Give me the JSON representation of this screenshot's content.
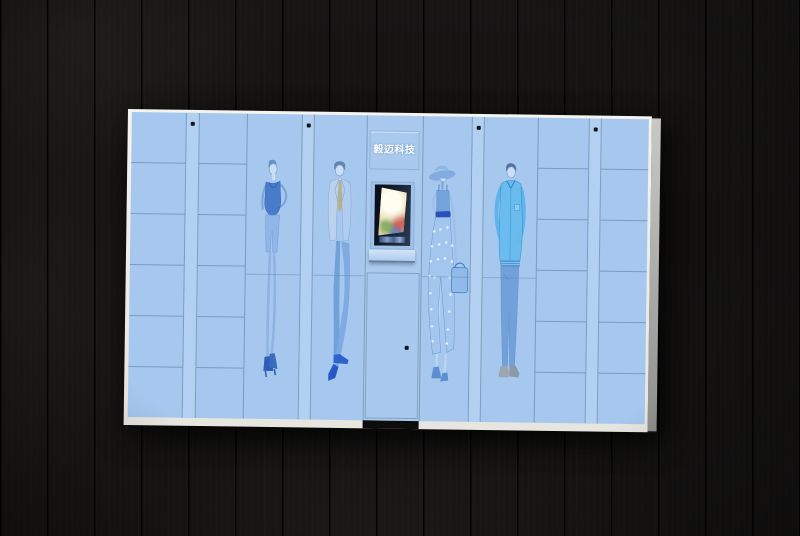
{
  "brand": {
    "label": "毅迈科技"
  },
  "palette": {
    "wall_wood": "#121110",
    "cabinet_face": "#a6c8ee",
    "cabinet_frame": "#efede8",
    "cabinet_side": "#b0b0ae",
    "door_seam": "#60789a",
    "screen_frame": "#1a2433",
    "screen_glow": "#fffdf0",
    "lock_dot": "#15161a",
    "figure_ink_dark": "#3e73c5",
    "figure_ink_light": "#8cb4e6",
    "tie_yellow": "#c2ae62",
    "jacket_cyan": "#67bcee"
  },
  "cabinet": {
    "small_locker_columns": 4,
    "compartments_per_small_column": 6,
    "small_compartments_total": 24,
    "large_display_doors": 4,
    "lock_dots": 5,
    "console_modules": [
      "brand-panel",
      "touch-screen",
      "keypad-ledge",
      "service-door"
    ]
  },
  "screen": {
    "content": "bright glowing promotional image on recessed kiosk display"
  },
  "figures": [
    {
      "name": "woman-tank-top-figure",
      "desc": "sketched woman in navy tank top, fitted shorts and heeled boots"
    },
    {
      "name": "man-suit-figure",
      "desc": "sketched man in pale suit with yellow tie and blue loafers, legs crossed"
    },
    {
      "name": "woman-hat-figure",
      "desc": "sketched woman in wide-brim hat and polka-dot midi skirt carrying a handbag"
    },
    {
      "name": "man-casual-figure",
      "desc": "sketched man in bright blue jacket and slim jeans"
    }
  ]
}
